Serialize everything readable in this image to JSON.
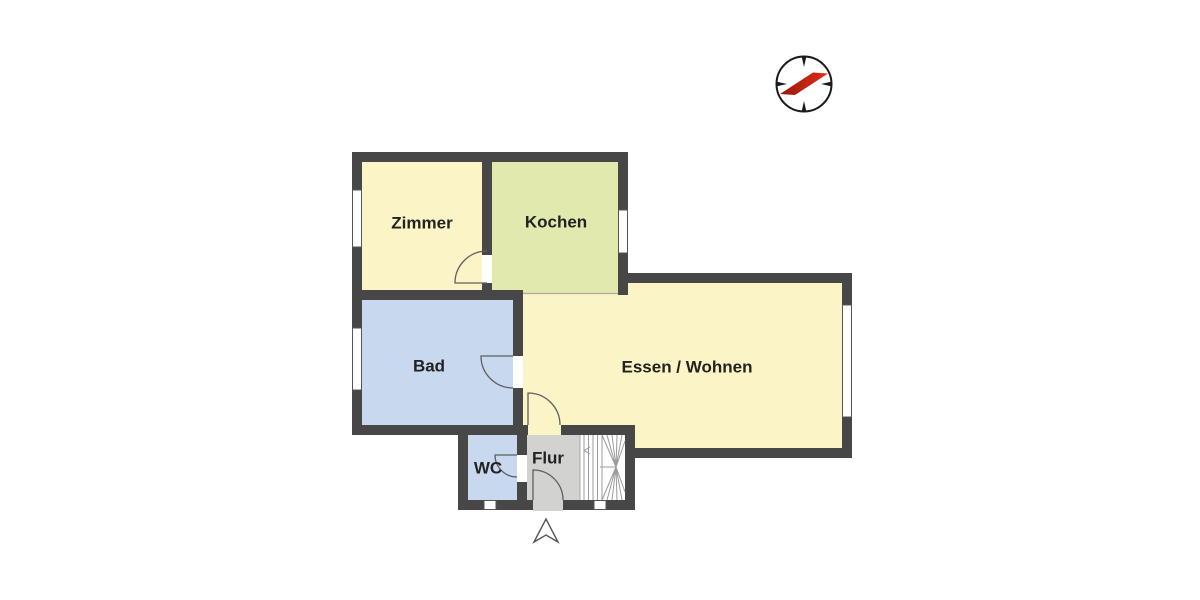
{
  "floorplan": {
    "rooms": [
      {
        "id": "zimmer",
        "label": "Zimmer",
        "color": "#faf4c6"
      },
      {
        "id": "kochen",
        "label": "Kochen",
        "color": "#e1e9af"
      },
      {
        "id": "bad",
        "label": "Bad",
        "color": "#c8d8ee"
      },
      {
        "id": "essen-wohnen",
        "label": "Essen / Wohnen",
        "color": "#faf4c6"
      },
      {
        "id": "wc",
        "label": "WC",
        "color": "#c8d8ee"
      },
      {
        "id": "flur",
        "label": "Flur",
        "color": "#d2d2d0"
      }
    ],
    "colors": {
      "wall": "#474747",
      "window": "#ffffff",
      "window_frame": "#565656",
      "door": "#5f5f5f",
      "stair_line": "#9b9b9b",
      "stair_area": "#ffffff",
      "room_boundary": "#aaaaa0",
      "label": "#222222",
      "background": "#ffffff",
      "entrance_arrow": "#555555"
    },
    "compass": {
      "ring": "#1a1a1a",
      "needle_dark": "#9c1708",
      "needle_bright": "#dd2f1b"
    },
    "icons": {
      "compass": "compass-rose-icon",
      "stairs_arrow": "stairs-direction-arrow-icon",
      "entrance": "entrance-arrow-icon"
    }
  }
}
